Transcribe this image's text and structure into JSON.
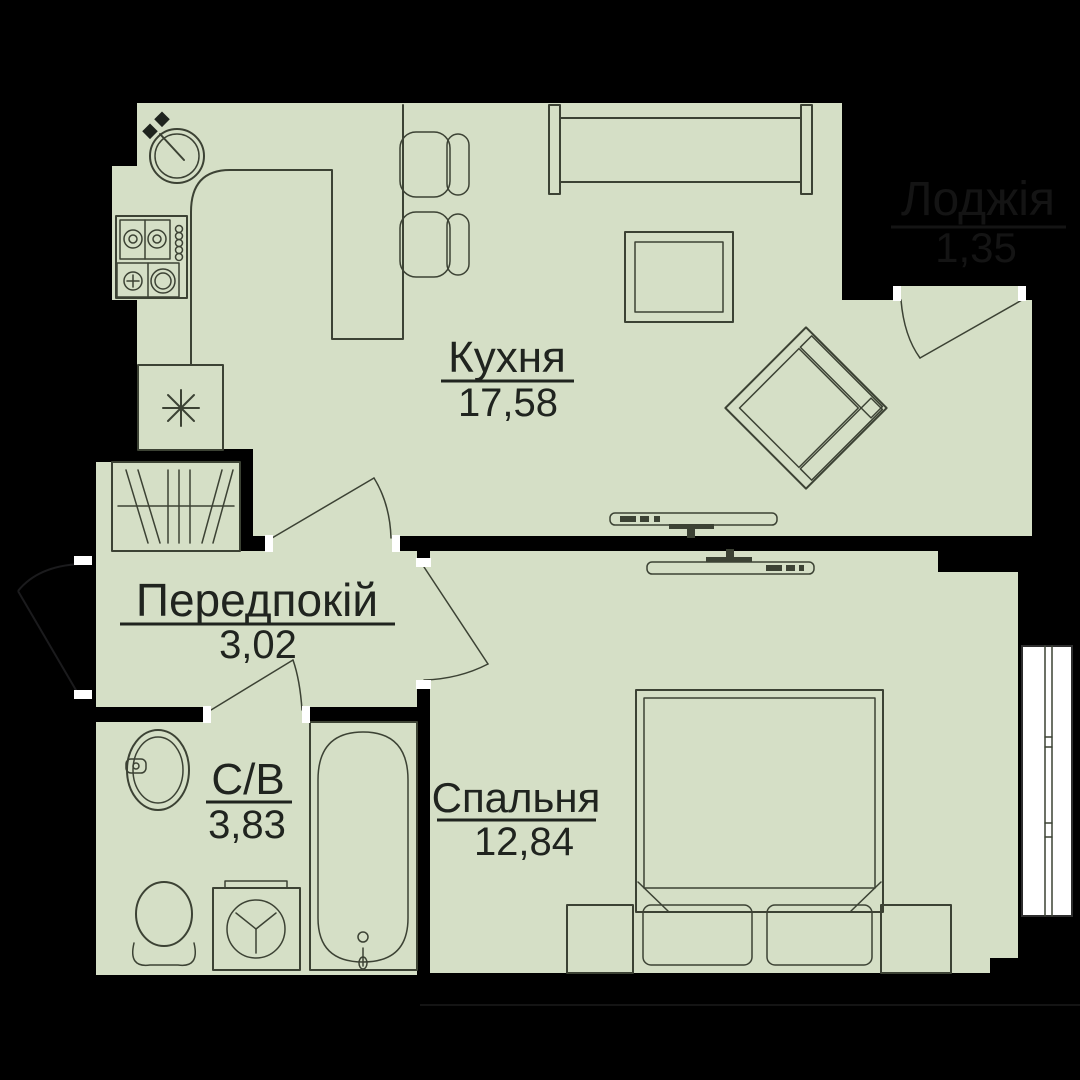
{
  "title": "Apartment floor plan (1-room)",
  "rooms": [
    {
      "key": "kitchen",
      "label": "Кухня",
      "area": "17,58"
    },
    {
      "key": "hallway",
      "label": "Передпокій",
      "area": "3,02"
    },
    {
      "key": "bathroom",
      "label": "С/В",
      "area": "3,83"
    },
    {
      "key": "bedroom",
      "label": "Спальня",
      "area": "12,84"
    },
    {
      "key": "loggia",
      "label": "Лоджія",
      "area": "1,35"
    }
  ],
  "colors": {
    "floor": "#d5dfc6",
    "line": "#3c4234",
    "wall": "#000000",
    "jamb": "#ffffff",
    "label": "#20241f",
    "loggia_label": "#141414"
  }
}
